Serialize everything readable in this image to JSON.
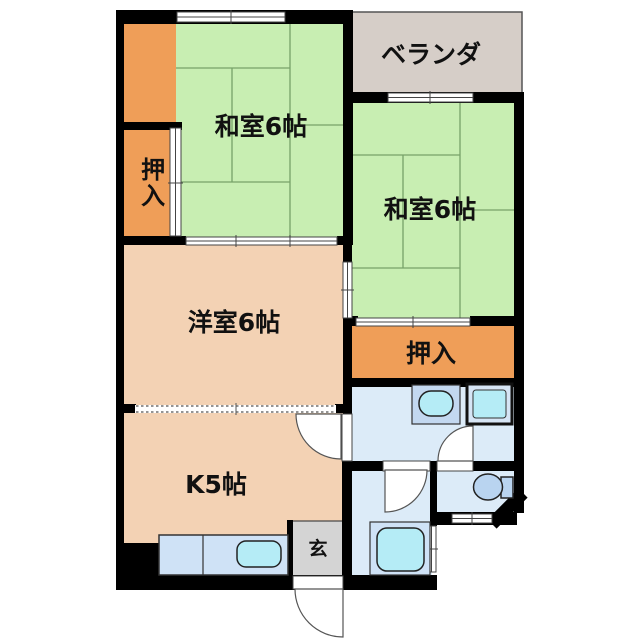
{
  "floorplan": {
    "type": "japanese-apartment-floor-plan",
    "rooms": {
      "washitsu_top": {
        "label": "和室6帖"
      },
      "washitsu_right": {
        "label": "和室6帖"
      },
      "western_room": {
        "label": "洋室6帖"
      },
      "kitchen": {
        "label": "K5帖"
      },
      "veranda": {
        "label": "ベランダ"
      },
      "closet_left": {
        "label": "押入"
      },
      "closet_right": {
        "label": "押入"
      },
      "entrance": {
        "label": "玄"
      }
    },
    "colors": {
      "tatami_green": "#c8eeb2",
      "tatami_line": "#77a269",
      "wood_tan": "#f3d2b4",
      "closet_orange": "#ef9e58",
      "veranda_gray": "#d6cec8",
      "entrance_gray": "#d4d4d4",
      "wet_area_blue": "#dcebf8",
      "fixture_blue": "#c3d8f0",
      "fixture_cyan": "#b5ecf6",
      "wall_black": "#000000"
    }
  }
}
